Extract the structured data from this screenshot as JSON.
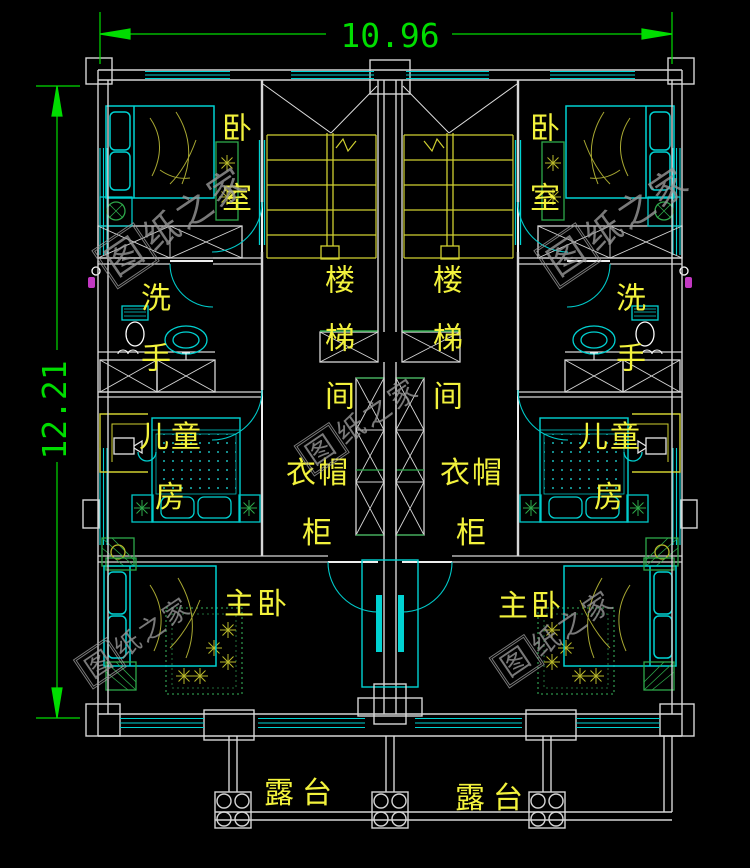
{
  "dimensions": {
    "top": "10.96",
    "left": "12.21"
  },
  "labels": {
    "bedroom": "卧室",
    "washroom": "洗手",
    "stairwell": "楼梯间",
    "wardrobe": "衣帽柜",
    "children": "儿童房",
    "master": "主卧",
    "terrace": "露台"
  },
  "watermark": {
    "first": "图",
    "rest": "纸之家"
  },
  "colors": {
    "background": "#000000",
    "dimension_green": "#00dd00",
    "label_yellow": "#f2f23c",
    "wall_white": "#d6d6d6",
    "window_cyan": "#00d2d2",
    "stair_yellow": "#cfcf30",
    "plant_green": "#2da84a",
    "watermark_gray": "#989898",
    "shower_purple": "#c238c2"
  }
}
